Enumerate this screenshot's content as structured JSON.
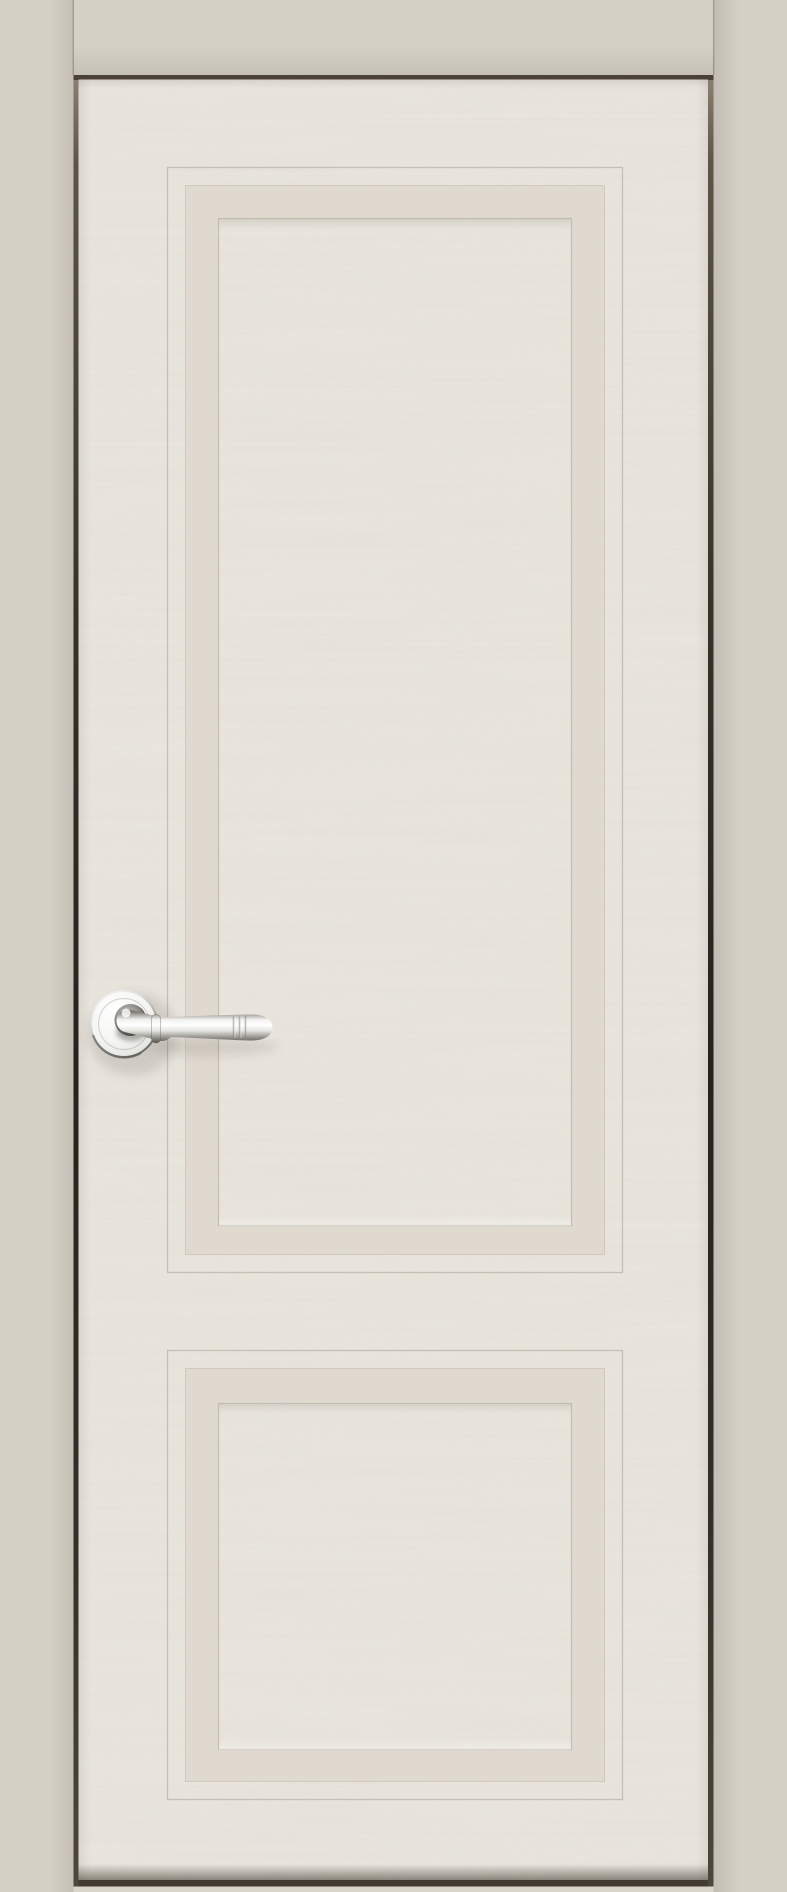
{
  "image": {
    "type": "product-photo",
    "description": "Straight-on photo of a closed classic interior door with two recessed framed panels, painted light ivory with visible ash wood grain, fitted in a matching greige door frame, with a polished chrome lever handle on a round rosette on the left stile.",
    "width_px": 787,
    "height_px": 1892
  },
  "door": {
    "leaf": "light ivory painted wood leaf with horizontal ash grain",
    "panel_count": 2,
    "panels": [
      {
        "name": "upper recessed panel",
        "shape": "tall rectangle with double-groove molding frame"
      },
      {
        "name": "lower recessed panel",
        "shape": "small rectangle with double-groove molding frame"
      }
    ],
    "handle": {
      "style": "lever on round rosette with knurled ring detail near tip",
      "finish": "polished chrome",
      "position": "left stile, lever pointing right"
    },
    "frame": "flat greige casing visible on left, top and right sides; dark shadow gap between leaf and frame; light floor strip under the door"
  },
  "colors": {
    "frame_casing": "#d5d0c6",
    "door_base": "#e9e6df",
    "wood_grain": "#cdc5b6",
    "molding_band": "#ded8ce",
    "groove_line": "#b7b0a3",
    "gap_top": "#4a4237",
    "gap_side": "#26221c",
    "door_bottom_gap": "#423b31",
    "floor_strip": "#dad5cb",
    "chrome_highlight": "#ffffff",
    "chrome_mid": "#cfcfcb",
    "chrome_shadow": "#54534d"
  }
}
